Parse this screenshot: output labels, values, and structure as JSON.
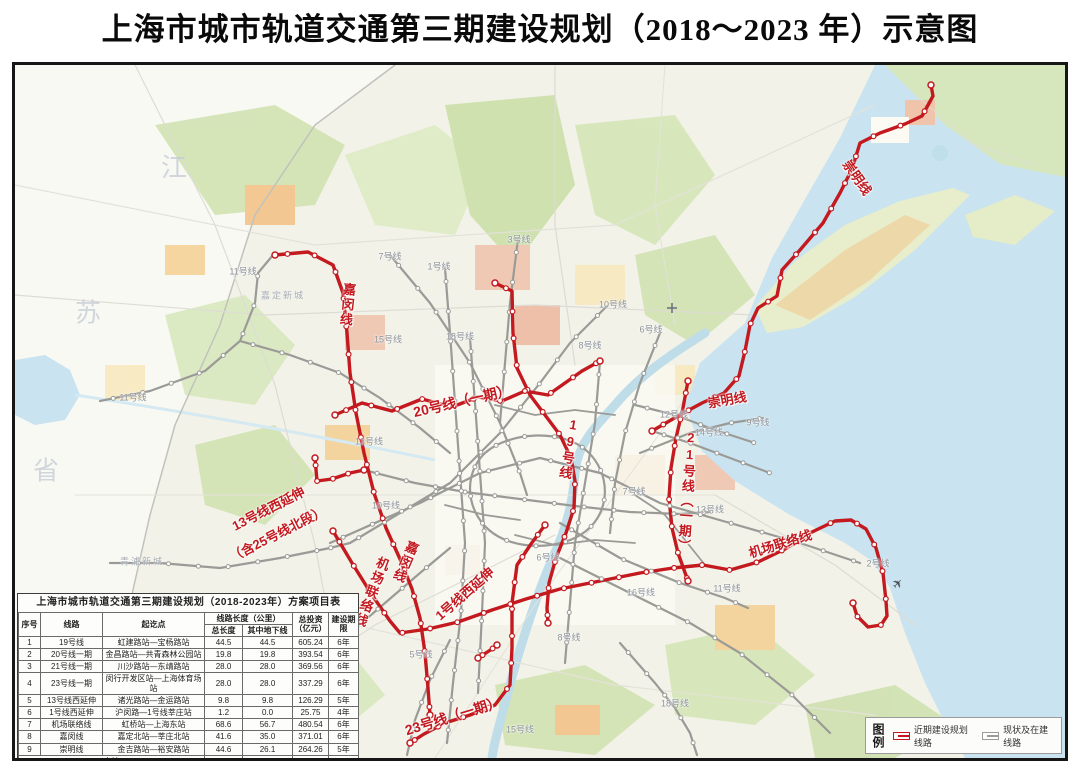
{
  "title": "上海市城市轨道交通第三期建设规划（2018～2023 年）示意图",
  "colors": {
    "planned_line": "#c3191f",
    "existing_line": "#9a9a97",
    "water": "#c9e3f0"
  },
  "map": {
    "province_chars": [
      "江",
      "苏",
      "省"
    ],
    "city_labels": [
      "嘉定新城",
      "青浦新城"
    ],
    "airplane_icon": "✈",
    "new_line_labels": {
      "jiamin_north": "嘉闵线",
      "chongming_island": "崇明线",
      "line20": "20号线（一期）",
      "line19": "19号线",
      "chongming_mid": "崇明线",
      "line21": "21号线（一期）",
      "airport_link_v": "机场联络线",
      "jiamin_mid": "嘉闵线",
      "line1_ext": "1号线西延伸",
      "line13_ext_row1": "13号线西延伸",
      "line13_ext_row2": "（含25号线北段）",
      "airport_link_h": "机场联络线",
      "line23": "23号线（一期）"
    },
    "existing_line_labels": [
      "11号线",
      "11号线",
      "11号线",
      "7号线",
      "7号线",
      "3号线",
      "1号线",
      "18号线",
      "18号线",
      "15号线",
      "15号线",
      "8号线",
      "8号线",
      "10号线",
      "10号线",
      "6号线",
      "6号线",
      "12号线",
      "14号线",
      "9号线",
      "13号线",
      "13号线",
      "16号线",
      "5号线",
      "2号线"
    ]
  },
  "table": {
    "title": "上海市城市轨道交通第三期建设规划（2018-2023年）方案项目表",
    "headers": {
      "index": "序号",
      "line": "线路",
      "endpoints": "起讫点",
      "length_group": "线路长度（公里）",
      "total_length": "总长度",
      "underground": "其中地下线",
      "investment": "总投资（亿元）",
      "period": "建设期限"
    },
    "rows": [
      [
        "1",
        "19号线",
        "虹建路站—宝杨路站",
        "44.5",
        "44.5",
        "605.24",
        "6年"
      ],
      [
        "2",
        "20号线一期",
        "金昌路站—共青森林公园站",
        "19.8",
        "19.8",
        "393.54",
        "6年"
      ],
      [
        "3",
        "21号线一期",
        "川沙路站—东靖路站",
        "28.0",
        "28.0",
        "369.56",
        "6年"
      ],
      [
        "4",
        "23号线一期",
        "闵行开发区站—上海体育场站",
        "28.0",
        "28.0",
        "337.29",
        "6年"
      ],
      [
        "5",
        "13号线西延伸",
        "诸光路站—金运路站",
        "9.8",
        "9.8",
        "126.29",
        "5年"
      ],
      [
        "6",
        "1号线西延伸",
        "沪闵路—1号线莘庄站",
        "1.2",
        "0.0",
        "25.75",
        "4年"
      ],
      [
        "7",
        "机场联络线",
        "虹桥站—上海东站",
        "68.6",
        "56.7",
        "480.54",
        "6年"
      ],
      [
        "8",
        "嘉闵线",
        "嘉定北站—莘庄北站",
        "41.6",
        "35.0",
        "371.01",
        "6年"
      ],
      [
        "9",
        "崇明线",
        "金吉路站—裕安路站",
        "44.6",
        "26.1",
        "264.26",
        "5年"
      ]
    ],
    "total": {
      "label": "合计",
      "total_length": "286.1",
      "underground": "247.9",
      "investment": "2983.48"
    }
  },
  "legend": {
    "title": "图例",
    "items": [
      {
        "label": "近期建设规划线路",
        "color": "#c3191f"
      },
      {
        "label": "现状及在建线路",
        "color": "#9a9a97"
      }
    ]
  }
}
